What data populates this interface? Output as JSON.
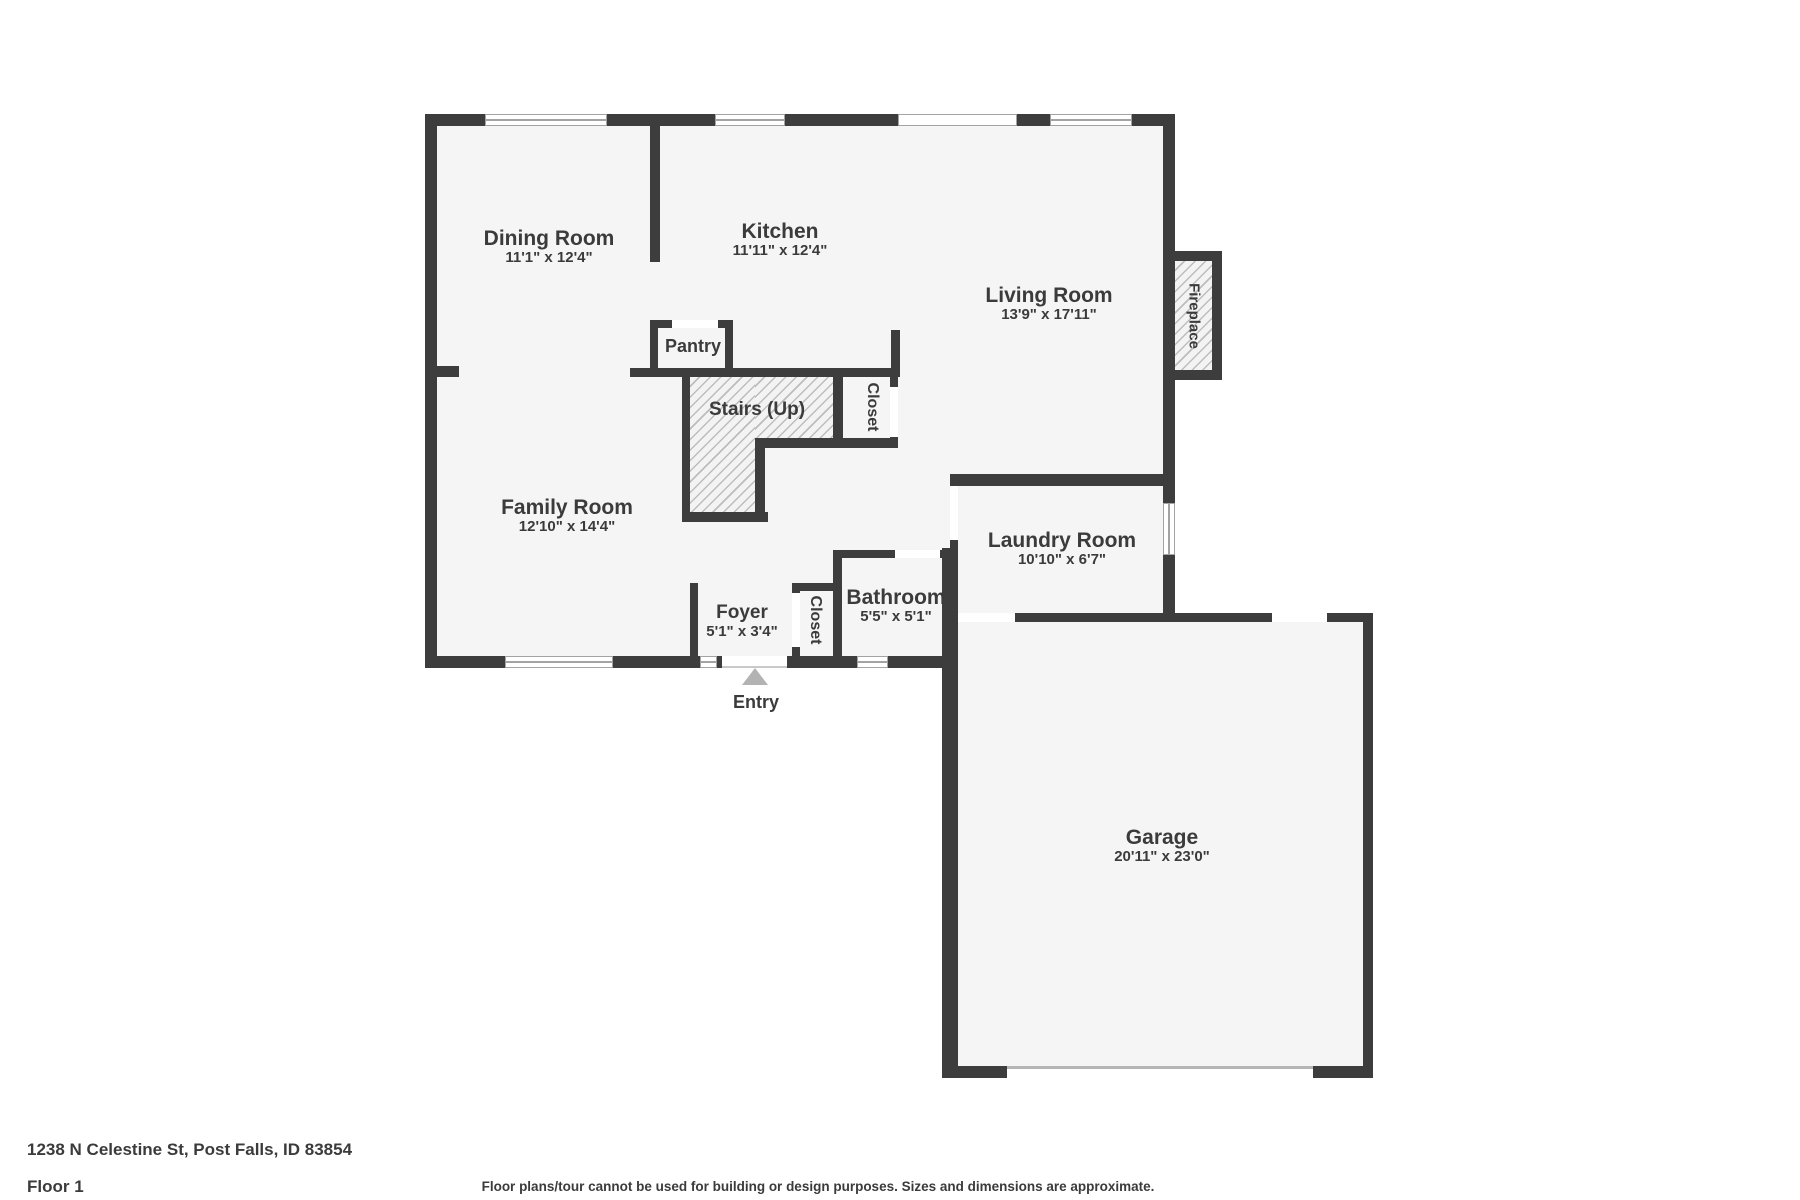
{
  "meta": {
    "address": "1238 N Celestine St, Post Falls, ID 83854",
    "floor_label": "Floor 1",
    "disclaimer": "Floor plans/tour cannot be used for building or design purposes. Sizes and dimensions are approximate."
  },
  "colors": {
    "wall": "#3d3d3d",
    "floor": "#f5f5f5",
    "outside": "#ffffff",
    "hatch_bg": "#f3f3f3",
    "hatch_line": "#bdbdbd",
    "opening_line": "#a3a3a3",
    "arrow": "#b3b3b3",
    "text": "#3b3b3b"
  },
  "rooms": {
    "dining": {
      "name": "Dining Room",
      "dims": "11'1\" x 12'4\""
    },
    "kitchen": {
      "name": "Kitchen",
      "dims": "11'11\" x 12'4\""
    },
    "living": {
      "name": "Living Room",
      "dims": "13'9\" x 17'11\""
    },
    "family": {
      "name": "Family Room",
      "dims": "12'10\" x 14'4\""
    },
    "laundry": {
      "name": "Laundry Room",
      "dims": "10'10\" x 6'7\""
    },
    "bathroom": {
      "name": "Bathroom",
      "dims": "5'5\" x 5'1\""
    },
    "foyer": {
      "name": "Foyer",
      "dims": "5'1\" x 3'4\""
    },
    "garage": {
      "name": "Garage",
      "dims": "20'11\" x 23'0\""
    },
    "pantry": {
      "name": "Pantry"
    },
    "stairs": {
      "name": "Stairs (Up)"
    },
    "closet_hall": {
      "name": "Closet"
    },
    "closet_foyer": {
      "name": "Closet"
    },
    "fireplace": {
      "name": "Fireplace"
    },
    "entry": {
      "name": "Entry"
    }
  }
}
